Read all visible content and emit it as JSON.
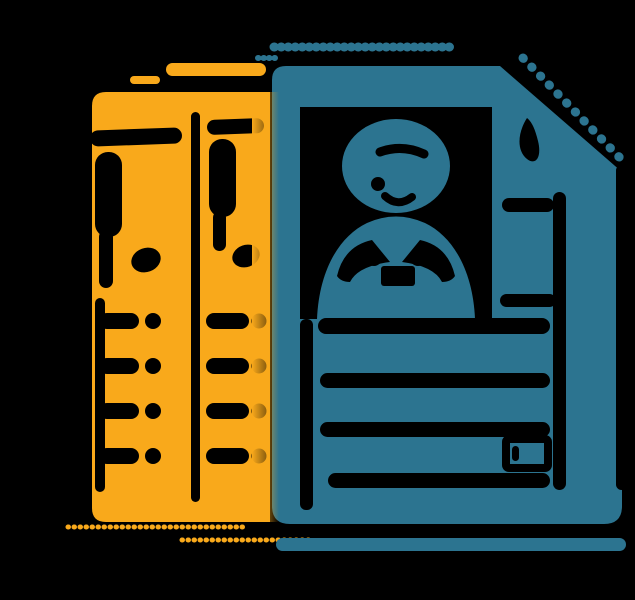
{
  "scene": {
    "description": "Flat illustration of a teal CV resume document with a folded top-right corner and a person portrait photo, stacked in front of two overlapping yellow document pages, on a black background",
    "background": "#000000"
  },
  "colors": {
    "bg": "#000000",
    "yellow": "#F9A91B",
    "teal": "#2C7490",
    "ink": "#000000"
  },
  "elements": {
    "front_document": "teal-cv-page-with-folded-corner",
    "portrait": "avatar-bust-in-photo-frame",
    "back_documents": "two-overlapping-yellow-pages",
    "cv_text_lines_count": 4,
    "yellow_bullet_rows_per_page": 4,
    "accents": [
      "teal-dotted-top-line",
      "teal-fold-dotted-line",
      "yellow-highlight-pill",
      "yellow-dotted-underlines",
      "teal-ground-bar"
    ]
  }
}
